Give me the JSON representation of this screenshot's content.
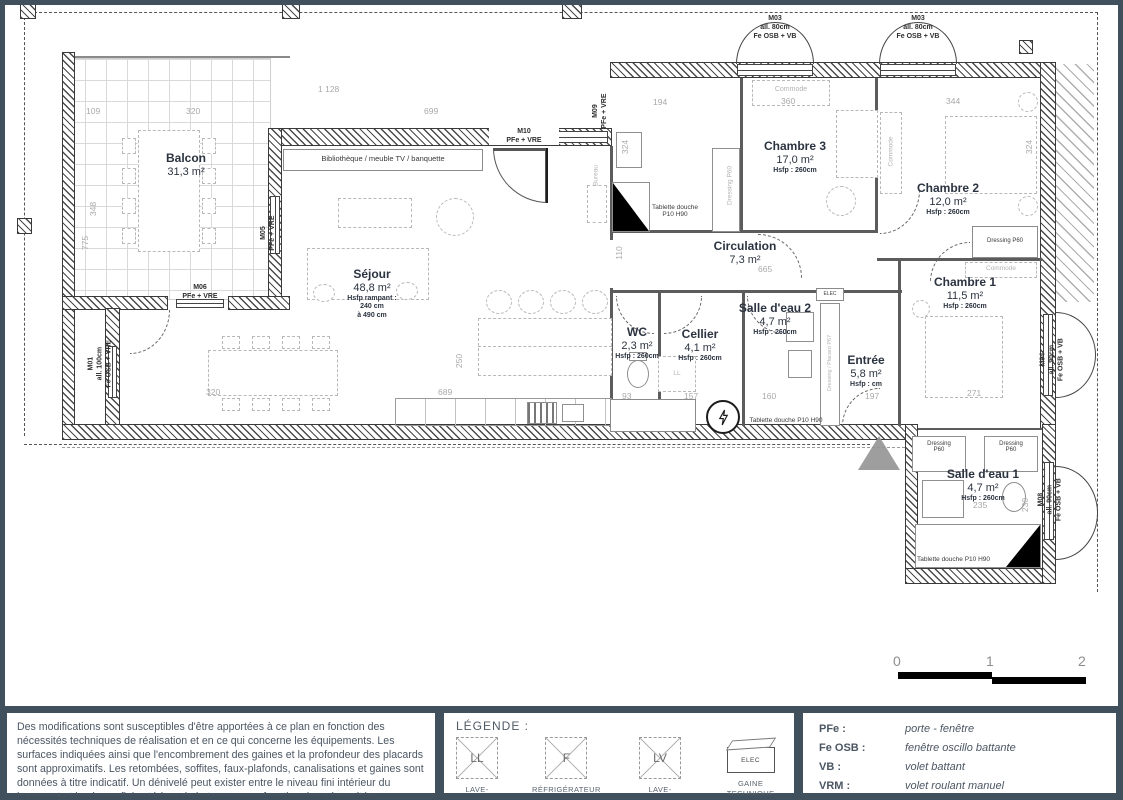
{
  "plan": {
    "rooms": [
      {
        "name": "Balcon",
        "area": "31,3 m²",
        "hsfp": ""
      },
      {
        "name": "Séjour",
        "area": "48,8 m²",
        "hsfp": "Hsfp rampant :\n240 cm\nà 490 cm"
      },
      {
        "name": "Chambre 3",
        "area": "17,0 m²",
        "hsfp": "Hsfp : 260cm"
      },
      {
        "name": "Chambre 2",
        "area": "12,0 m²",
        "hsfp": "Hsfp : 260cm"
      },
      {
        "name": "Chambre 1",
        "area": "11,5 m²",
        "hsfp": "Hsfp : 260cm"
      },
      {
        "name": "Circulation",
        "area": "7,3 m²",
        "hsfp": ""
      },
      {
        "name": "WC",
        "area": "2,3 m²",
        "hsfp": "Hsfp : 260cm"
      },
      {
        "name": "Cellier",
        "area": "4,1 m²",
        "hsfp": "Hsfp : 260cm"
      },
      {
        "name": "Salle d'eau 2",
        "area": "4,7 m²",
        "hsfp": "Hsfp : 260cm"
      },
      {
        "name": "Entrée",
        "area": "5,8 m²",
        "hsfp": "Hsfp : cm"
      },
      {
        "name": "Salle d'eau 1",
        "area": "4,7 m²",
        "hsfp": "Hsfp : 260cm"
      }
    ],
    "openings": [
      "M01\nall. 100cm\nFe OSB + VRE",
      "M05\nPFe + VRE",
      "M06\nPFe + VRE",
      "M09\nPFe + VRE",
      "M10\nPFe + VRE",
      "M03\nall. 80cm\nFe OSB + VB",
      "M03\nall. 80cm\nFe OSB + VB",
      "M04\nall. 90cm\nFe OSB + VB",
      "M08\nall. 90cm\nFe OSB + VB"
    ],
    "annotations": {
      "biblio": "Bibliothèque / meuble TV / banquette",
      "tablette_bain3": "Tablette douche\nP10 H90",
      "tablette_sde2": "Tablette douche P10 H90",
      "tablette_sde1": "Tablette douche P10 H90",
      "dressing_bain3": "Dressing P60",
      "dressing_ch2": "Dressing P60",
      "dressing_sde1a": "Dressing\nP60",
      "dressing_sde1b": "Dressing\nP60",
      "commode_ch3": "Commode",
      "commode_ch2": "Commode",
      "commode_ch1": "Commode",
      "bureau": "Bureau",
      "placard": "Dressing / Placard P67",
      "elec": "ELEC",
      "ll": "LL",
      "lv": "LV"
    },
    "dims": [
      "1 128",
      "109",
      "320",
      "699",
      "194",
      "360",
      "344",
      "775",
      "348",
      "665",
      "110",
      "324",
      "250",
      "320",
      "689",
      "93",
      "157",
      "160",
      "197",
      "271",
      "235",
      "230",
      "324"
    ],
    "scale": {
      "n0": "0",
      "n1": "1",
      "n2": "2"
    }
  },
  "footer": {
    "disclaimer": "Des modifications sont susceptibles d'être apportées à ce plan en fonction des nécessités techniques de réalisation et en ce qui concerne les équipements. Les surfaces indiquées ainsi que l'encombrement des gaines et la profondeur des placards sont approximatifs. Les retombées, soffites, faux-plafonds, canalisations et gaines sont données à titre indicatif. Un dénivelé peut exister entre le niveau fini intérieur du logement et le niveau fini extérieur de la terrasse en fonction des nécessités techniques de réalisation.",
    "legend": {
      "title": "LÉGENDE :",
      "items": [
        {
          "symbol": "LL",
          "label": "LAVE-LINGE"
        },
        {
          "symbol": "F",
          "label": "RÉFRIGÉRATEUR"
        },
        {
          "symbol": "LV",
          "label": "LAVE-VAISSELLE"
        },
        {
          "symbol": "ELEC",
          "label": "GAINE TECHNIQUE\nDE LOGEMENT (GTL)"
        }
      ]
    },
    "abbreviations": [
      {
        "abbr": "PFe :",
        "meaning": "porte - fenêtre"
      },
      {
        "abbr": "Fe OSB :",
        "meaning": "fenêtre oscillo battante"
      },
      {
        "abbr": "VB :",
        "meaning": "volet battant"
      },
      {
        "abbr": "VRM :",
        "meaning": "volet roulant manuel"
      },
      {
        "abbr": "VRE :",
        "meaning": "volet roulant électrique"
      }
    ],
    "colors": {
      "frame": "#41505d",
      "dim_text": "#a9a9a9",
      "line": "#3a3a3a"
    }
  }
}
